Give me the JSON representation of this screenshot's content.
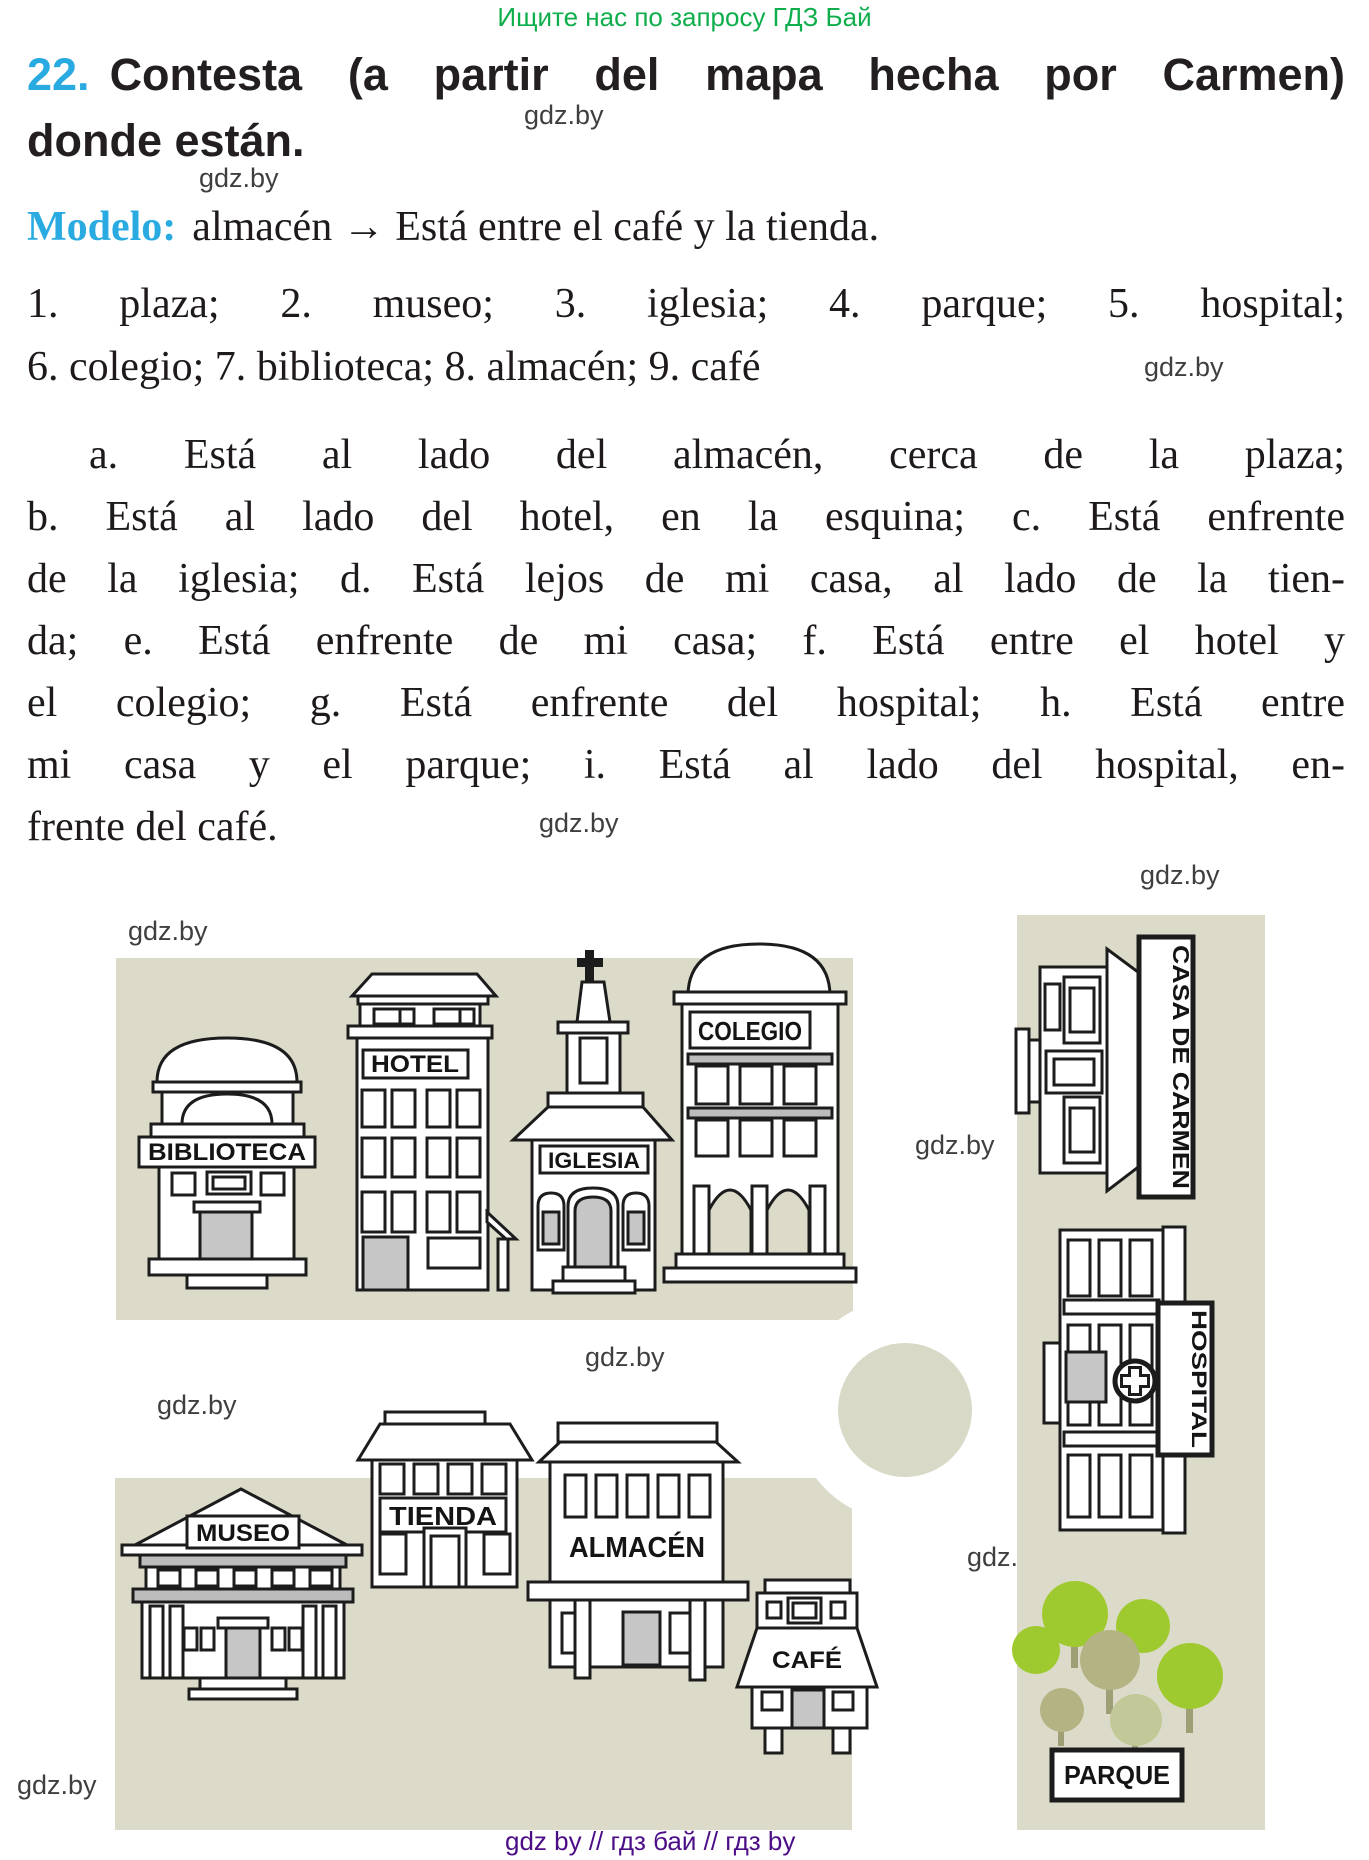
{
  "page": {
    "header_promo": "Ищите нас по запросу ГДЗ Бай",
    "watermark": "gdz.by",
    "footer": "gdz by  //  гдз бай  //  гдз by",
    "colors": {
      "accent_cyan": "#29abe2",
      "promo_green": "#0fae4c",
      "footer_purple": "#4c0d86",
      "text_black": "#231f20",
      "watermark_gray": "#3f3f3f"
    }
  },
  "exercise": {
    "number": "22.",
    "title_rest": "Contesta (a partir del mapa hecha por Carmen)",
    "title_line2": "donde están.",
    "model_label": "Modelo:",
    "model_text": "almacén → Está entre el café y la tienda.",
    "items_line1": "1. plaza; 2. museo; 3. iglesia; 4. parque; 5. hospital;",
    "items_line2": "6. colegio; 7. biblioteca; 8. almacén; 9. café",
    "answer_lines": [
      "a. Está al lado del almacén, cerca de la plaza;",
      "b. Está al lado del hotel, en la esquina; c. Está enfrente",
      "de la iglesia; d. Está lejos de mi casa, al lado de la tien-",
      "da; e. Está enfrente de mi casa; f. Está entre el hotel y",
      "el colegio; g. Está enfrente del hospital; h. Está entre",
      "mi casa y el parque; i. Está al lado del hospital, en-",
      "frente del café."
    ]
  },
  "map": {
    "labels": {
      "biblioteca": "BIBLIOTECA",
      "hotel": "HOTEL",
      "iglesia": "IGLESIA",
      "colegio": "COLEGIO",
      "casa_de_carmen": "CASA DE CARMEN",
      "hospital": "HOSPITAL",
      "museo": "MUSEO",
      "tienda": "TIENDA",
      "almacen": "ALMACÉN",
      "cafe": "CAFÉ",
      "parque": "PARQUE"
    },
    "colors": {
      "block_background": "#dcdbca",
      "roundabout": "#d9d9c8",
      "biblioteca_dome": "#c468be",
      "hotel_roof": "#2497a8",
      "iglesia_roof": "#f5a13b",
      "colegio_dome": "#ec1a4e",
      "casa_de_carmen_side": "#ec8a63",
      "tienda_roof": "#8a84cc",
      "almacen_roof": "#f2a6a9",
      "cafe_strip": "#e52421",
      "tree_green": "#9fca2f",
      "tree_olive": "#b3b383",
      "tree_light": "#c2c897",
      "door_gray": "#c6c6c6"
    }
  }
}
